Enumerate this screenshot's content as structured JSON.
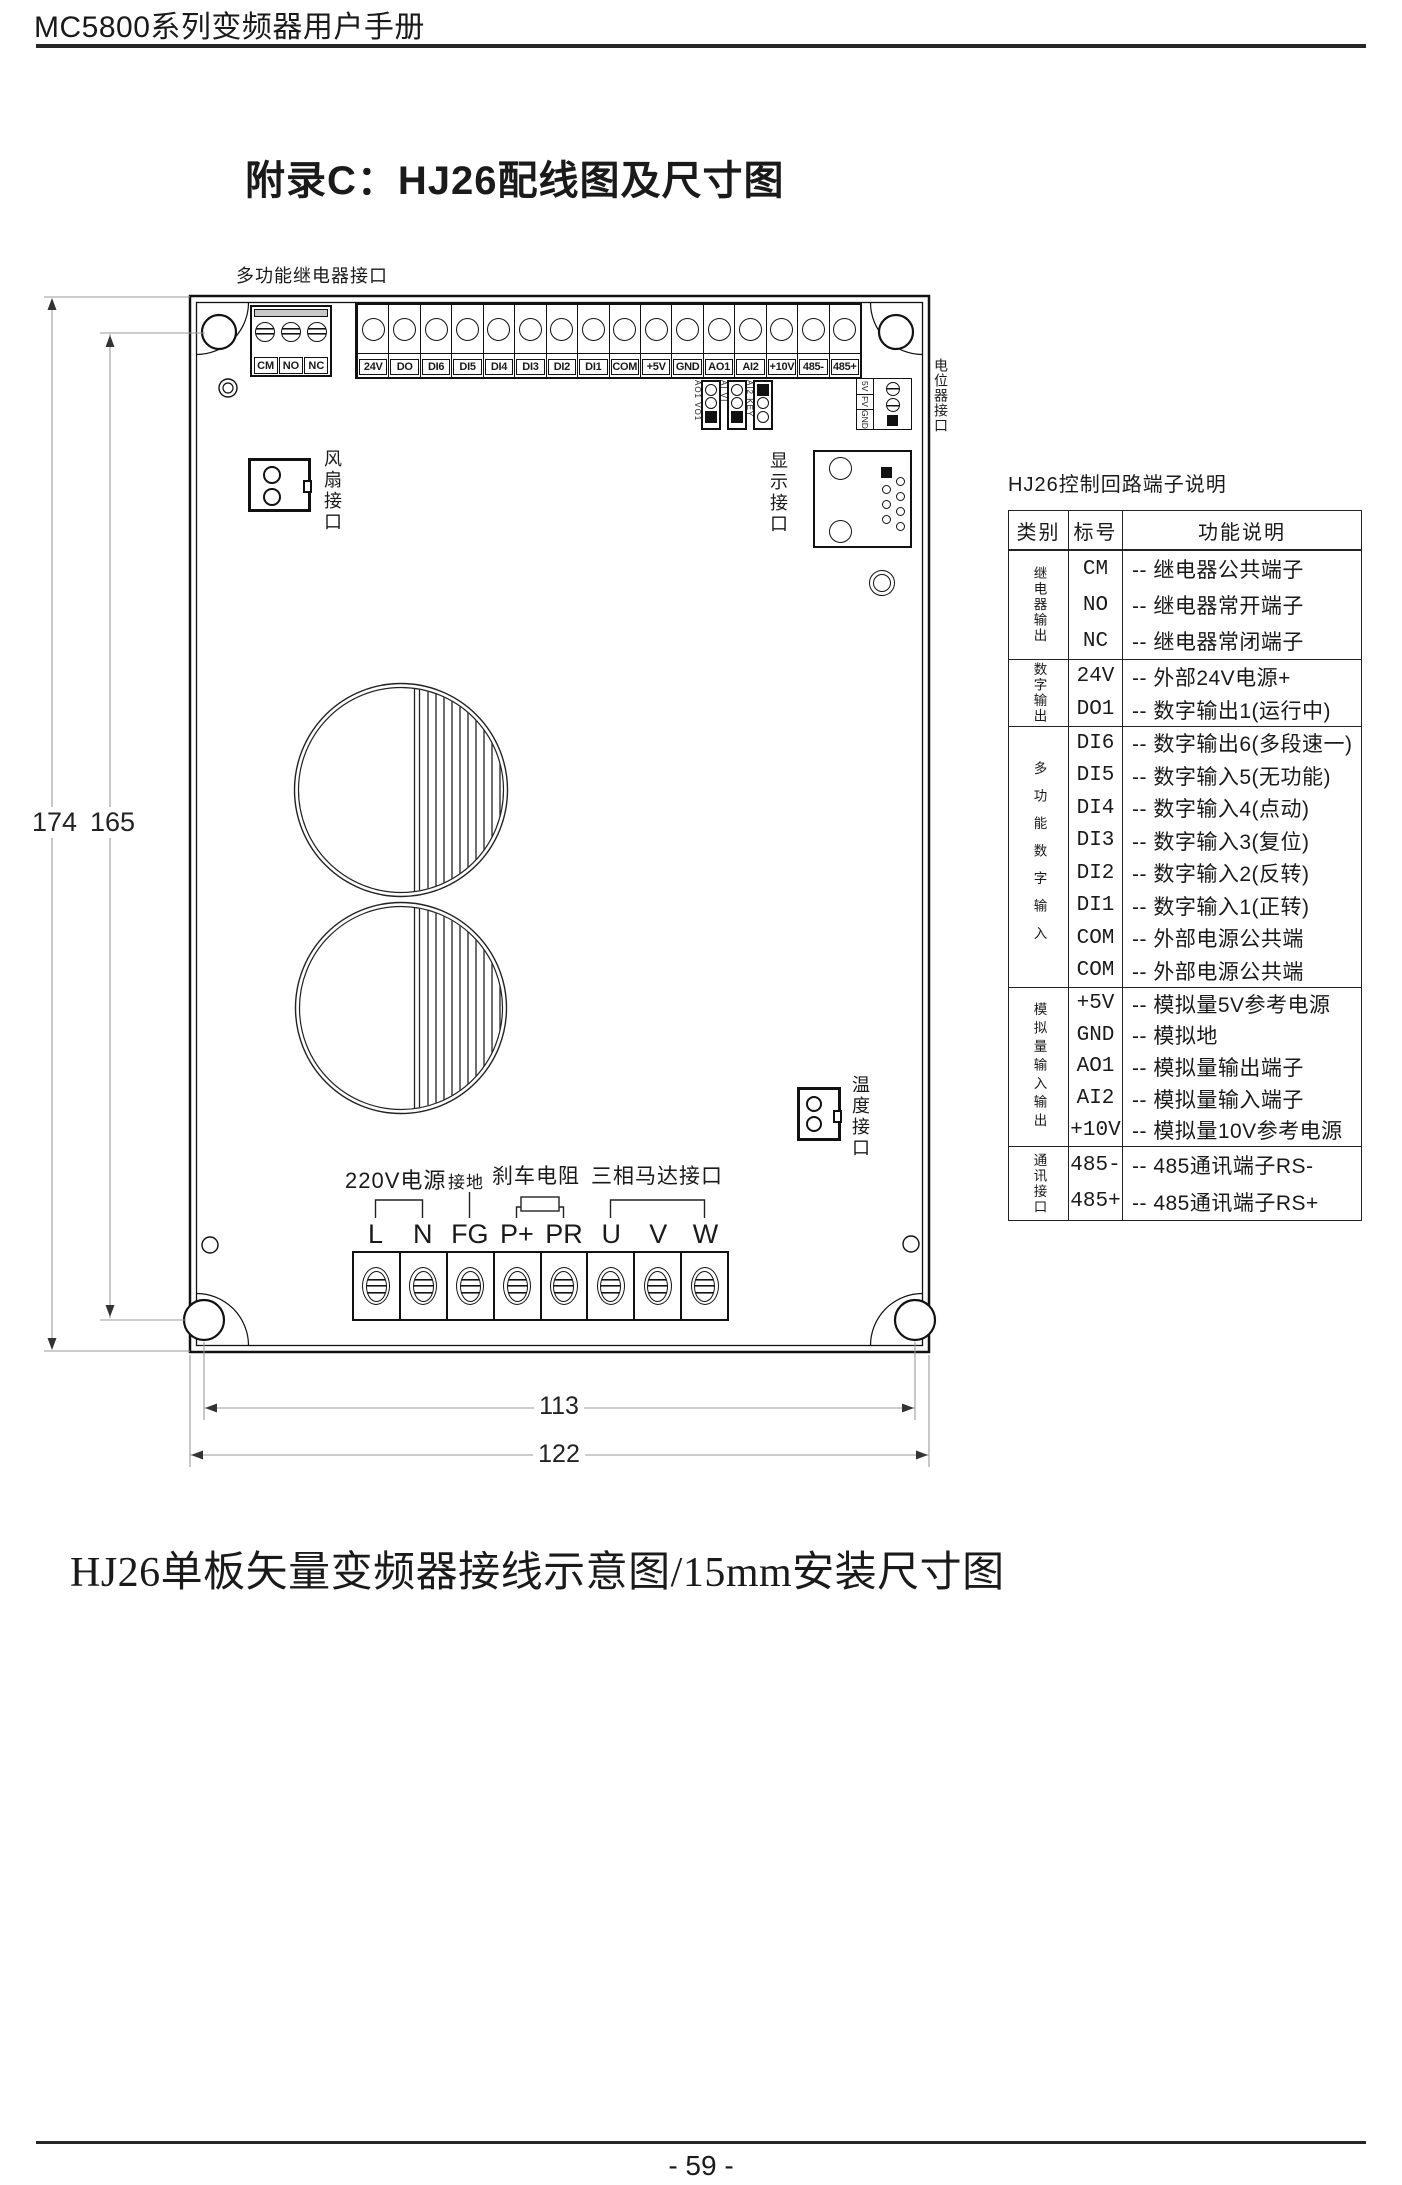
{
  "header": {
    "title": "MC5800系列变频器用户手册"
  },
  "titles": {
    "appendix": "附录C：HJ26配线图及尺寸图",
    "caption": "HJ26单板矢量变频器接线示意图/15mm安装尺寸图",
    "page_number": "- 59 -"
  },
  "board": {
    "relay_label": "多功能继电器接口",
    "relay_terminals": [
      "CM",
      "NO",
      "NC"
    ],
    "control_terminals": [
      "24V",
      "DO",
      "DI6",
      "DI5",
      "DI4",
      "DI3",
      "DI2",
      "DI1",
      "COM",
      "+5V",
      "GND",
      "AO1",
      "AI2",
      "+10V",
      "485-",
      "485+"
    ],
    "jumper_labels": [
      "AO1 VO1",
      "AI VI",
      "AI2 KEY"
    ],
    "pot_pins": [
      "5V",
      "FV",
      "GND"
    ],
    "labels": {
      "fan": "风扇接口",
      "display": "显示接口",
      "pot": "电位器接口",
      "temp": "温度接口"
    },
    "power_labels": {
      "supply": "220V电源",
      "ground": "接地",
      "brake": "刹车电阻",
      "motor": "三相马达接口"
    },
    "power_terminals": [
      "L",
      "N",
      "FG",
      "P+",
      "PR",
      "U",
      "V",
      "W"
    ],
    "dims": {
      "h_outer": "174",
      "h_holes": "165",
      "w_holes": "113",
      "w_outer": "122"
    }
  },
  "table": {
    "title": "HJ26控制回路端子说明",
    "headers": [
      "类别",
      "标号",
      "功能说明"
    ],
    "groups": [
      {
        "category": "继电器输出",
        "rows": [
          {
            "code": "CM",
            "desc": "-- 继电器公共端子"
          },
          {
            "code": "NO",
            "desc": "-- 继电器常开端子"
          },
          {
            "code": "NC",
            "desc": "-- 继电器常闭端子"
          }
        ]
      },
      {
        "category": "数字输出",
        "rows": [
          {
            "code": "24V",
            "desc": "-- 外部24V电源+"
          },
          {
            "code": "DO1",
            "desc": "-- 数字输出1(运行中)"
          }
        ]
      },
      {
        "category": "多功能数字输入",
        "rows": [
          {
            "code": "DI6",
            "desc": "-- 数字输出6(多段速一)"
          },
          {
            "code": "DI5",
            "desc": "-- 数字输入5(无功能)"
          },
          {
            "code": "DI4",
            "desc": "-- 数字输入4(点动)"
          },
          {
            "code": "DI3",
            "desc": "-- 数字输入3(复位)"
          },
          {
            "code": "DI2",
            "desc": "-- 数字输入2(反转)"
          },
          {
            "code": "DI1",
            "desc": "-- 数字输入1(正转)"
          },
          {
            "code": "COM",
            "desc": "-- 外部电源公共端"
          },
          {
            "code": "COM",
            "desc": "-- 外部电源公共端"
          }
        ]
      },
      {
        "category": "模拟量输入输出",
        "rows": [
          {
            "code": "+5V",
            "desc": "-- 模拟量5V参考电源"
          },
          {
            "code": "GND",
            "desc": "-- 模拟地"
          },
          {
            "code": "AO1",
            "desc": "-- 模拟量输出端子"
          },
          {
            "code": "AI2",
            "desc": "-- 模拟量输入端子"
          },
          {
            "code": "+10V",
            "desc": "-- 模拟量10V参考电源"
          }
        ]
      },
      {
        "category": "通讯接口",
        "rows": [
          {
            "code": "485-",
            "desc": "-- 485通讯端子RS-"
          },
          {
            "code": "485+",
            "desc": "-- 485通讯端子RS+"
          }
        ]
      }
    ]
  }
}
